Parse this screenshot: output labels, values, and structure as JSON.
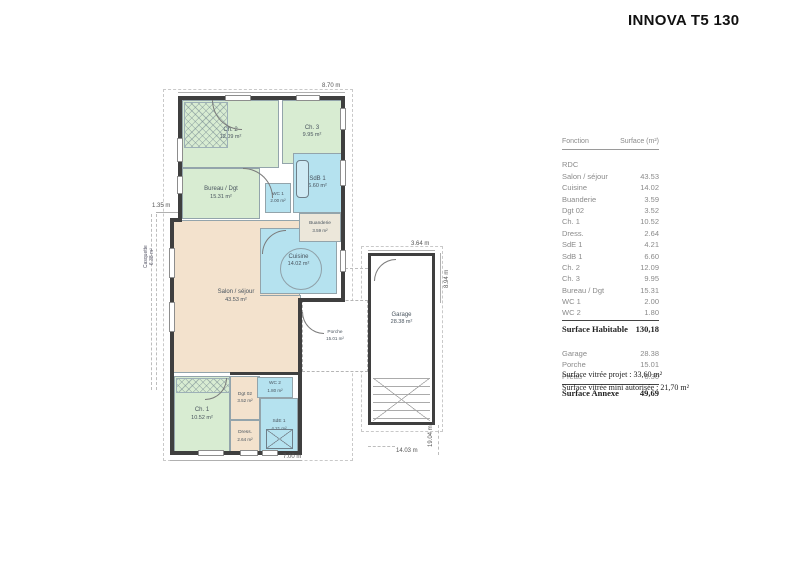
{
  "title": "INNOVA T5 130",
  "table": {
    "headers": [
      "Fonction",
      "Surface (m²)"
    ],
    "section": "RDC",
    "rows": [
      {
        "label": "Salon / séjour",
        "value": "43.53"
      },
      {
        "label": "Cuisine",
        "value": "14.02"
      },
      {
        "label": "Buanderie",
        "value": "3.59"
      },
      {
        "label": "Dgt 02",
        "value": "3.52"
      },
      {
        "label": "Ch. 1",
        "value": "10.52"
      },
      {
        "label": "Dress.",
        "value": "2.64"
      },
      {
        "label": "SdE 1",
        "value": "4.21"
      },
      {
        "label": "SdB 1",
        "value": "6.60"
      },
      {
        "label": "Ch. 2",
        "value": "12.09"
      },
      {
        "label": "Ch. 3",
        "value": "9.95"
      },
      {
        "label": "Bureau / Dgt",
        "value": "15.31"
      },
      {
        "label": "WC 1",
        "value": "2.00"
      },
      {
        "label": "WC 2",
        "value": "1.80"
      }
    ],
    "habitable": {
      "label": "Surface Habitable",
      "value": "130,18"
    },
    "annex_rows": [
      {
        "label": "Garage",
        "value": "28.38"
      },
      {
        "label": "Porche",
        "value": "15.01"
      },
      {
        "label": "Préau",
        "value": "6.30"
      }
    ],
    "annexe": {
      "label": "Surface Annexe",
      "value": "49,69"
    },
    "notes": [
      "Surface vitrée projet :  33,60 m²",
      "Surface vitrée mini autorisée :  21,70 m²"
    ]
  },
  "plan": {
    "rooms": {
      "salon": {
        "name": "Salon / séjour",
        "area": "43.53 m²"
      },
      "cuisine": {
        "name": "Cuisine",
        "area": "14.02 m²"
      },
      "buanderie": {
        "name": "Buanderie",
        "area": "3.59 m²"
      },
      "ch2": {
        "name": "Ch. 2",
        "area": "12.09 m²"
      },
      "ch3": {
        "name": "Ch. 3",
        "area": "9.95 m²"
      },
      "bureau": {
        "name": "Bureau / Dgt",
        "area": "15.31 m²"
      },
      "wc1": {
        "name": "WC 1",
        "area": "2.00 m²"
      },
      "sdb1": {
        "name": "SdB 1",
        "area": "6.60 m²"
      },
      "ch1": {
        "name": "Ch. 1",
        "area": "10.52 m²"
      },
      "dgt02": {
        "name": "Dgt 02",
        "area": "3.52 m²"
      },
      "dress": {
        "name": "Dress.",
        "area": "2.64 m²"
      },
      "wc2": {
        "name": "WC 2",
        "area": "1.80 m²"
      },
      "sde1": {
        "name": "SdE 1",
        "area": "4.21 m²"
      },
      "porche": {
        "name": "Porche",
        "area": "15.01 m²"
      },
      "garage": {
        "name": "Garage",
        "area": "28.38 m²"
      },
      "casquette": {
        "name": "Casquette",
        "area": "6.38 m²"
      }
    },
    "dims": {
      "d870": "8.70 m",
      "d135": "1.35 m",
      "d364": "3.64 m",
      "d894": "8.94 m",
      "d700": "7.00 m",
      "d1403": "14.03 m",
      "d1904": "19.04 m"
    }
  },
  "colors": {
    "bedroom_green": "#d8ecd2",
    "water_blue": "#b5e2ef",
    "living_tan": "#f3e2cd",
    "wall_dark": "#3f3f3f"
  }
}
